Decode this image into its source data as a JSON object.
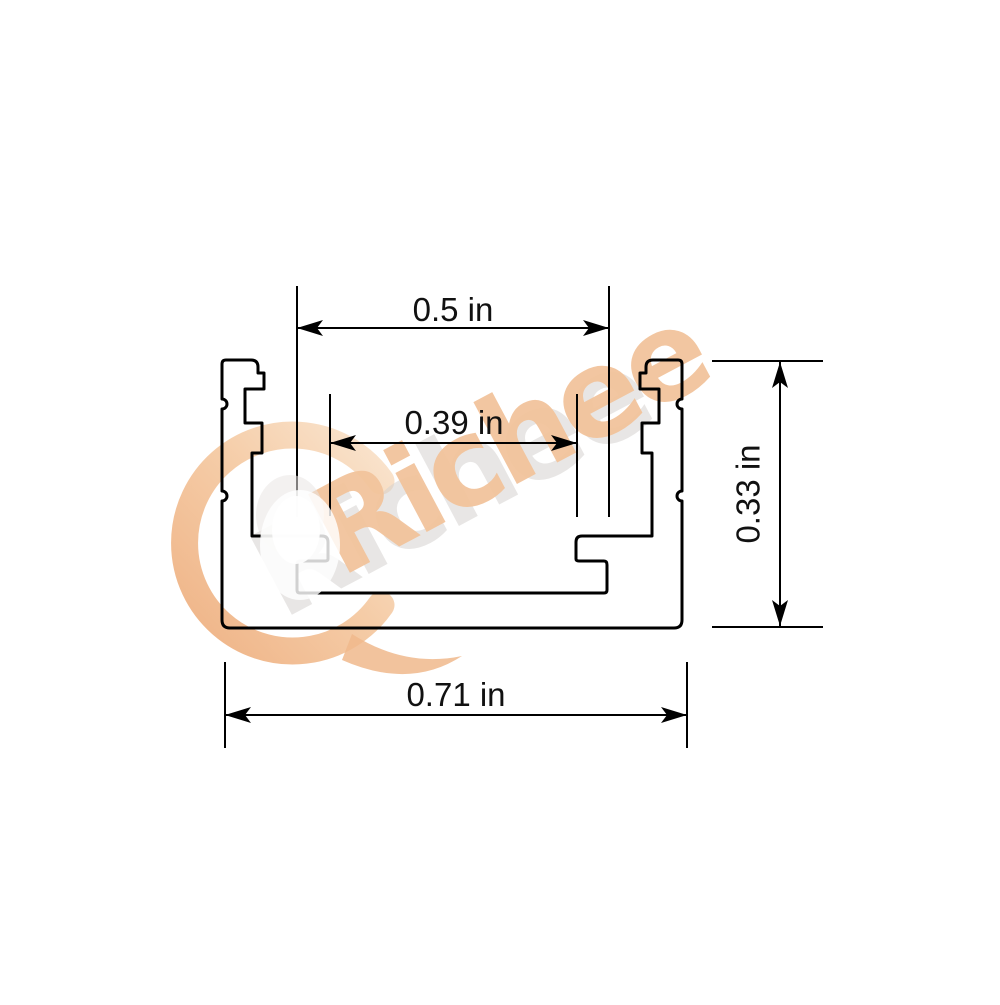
{
  "drawing": {
    "kind": "profile-cross-section",
    "line_color": "#000000",
    "background_color": "#ffffff",
    "dimensions": {
      "top_width": {
        "label": "0.5 in",
        "value": 0.5,
        "unit": "in"
      },
      "inner_width": {
        "label": "0.39 in",
        "value": 0.39,
        "unit": "in"
      },
      "height": {
        "label": "0.33 in",
        "value": 0.33,
        "unit": "in"
      },
      "outer_width": {
        "label": "0.71 in",
        "value": 0.71,
        "unit": "in"
      }
    }
  },
  "watermark": {
    "text": "Richee",
    "peach_color": "#f2c49c",
    "peach_deep": "#edaa78",
    "peach_light": "#f9e2ca",
    "ghost_color": "#d6d3d0"
  }
}
